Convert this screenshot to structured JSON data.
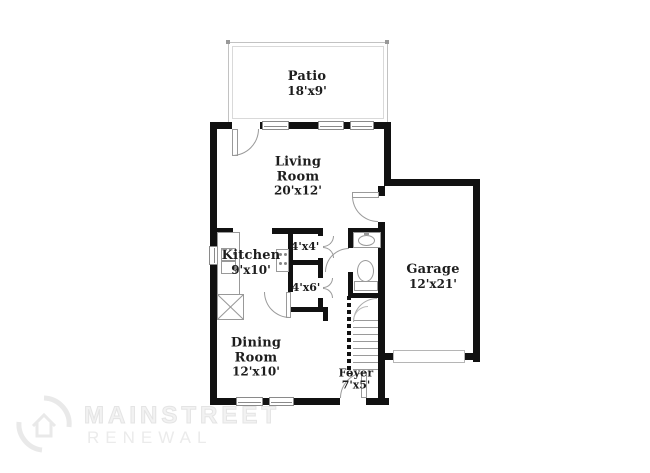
{
  "plan_type": "floor-plan",
  "rooms": {
    "patio": {
      "name": "Patio",
      "dims": "18'x9'"
    },
    "living_room": {
      "name": "Living Room",
      "dims": "20'x12'"
    },
    "kitchen": {
      "name": "Kitchen",
      "dims": "9'x10'"
    },
    "closet_a": {
      "dims": "4'x4'"
    },
    "closet_b": {
      "dims": "4'x6'"
    },
    "garage": {
      "name": "Garage",
      "dims": "12'x21'"
    },
    "dining_room": {
      "name": "Dining Room",
      "dims": "12'x10'"
    },
    "foyer": {
      "name": "Foyer",
      "dims": "7'x5'"
    }
  },
  "fixtures": [
    "kitchen-counter",
    "kitchen-sink",
    "range",
    "pantry-cabinet",
    "bathroom-sink",
    "toilet",
    "staircase",
    "garage-door",
    "windows",
    "doors"
  ],
  "watermark": {
    "line1": "MAINSTREET",
    "line2": "RENEWAL"
  },
  "colors": {
    "wall": "#111111",
    "label_text": "#1d1d1d",
    "door_arc": "#9a9a9a",
    "patio_outline": "#c2c2c2",
    "fixture_outline": "#999999",
    "watermark_text": "#ededed"
  }
}
